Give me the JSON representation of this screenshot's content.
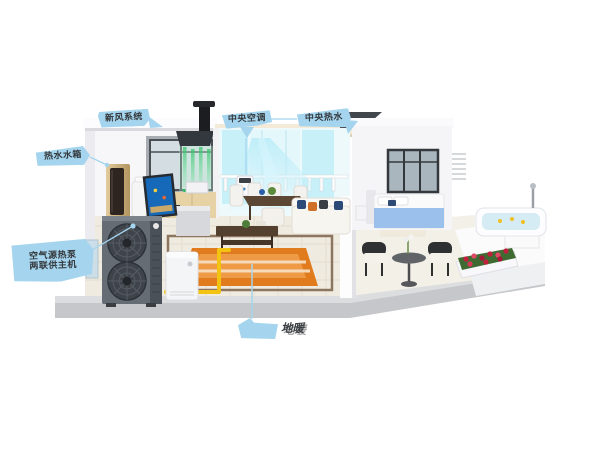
{
  "background_color": "#ffffff",
  "callouts": {
    "fresh_air": {
      "label": "新风系统"
    },
    "central_ac": {
      "label": "中央空调"
    },
    "central_hot_water": {
      "label": "中央热水"
    },
    "water_tank": {
      "label": "热水水箱"
    },
    "heat_pump": {
      "line1": "空气源热泵",
      "line2": "两联供主机"
    },
    "floor_heating": {
      "label": "地暖"
    }
  },
  "icons": {
    "callout_bubble": "blue-pointer-ribbon",
    "callout_dot": "circle-endpoint",
    "callout_arrow": "triangle-pointer"
  },
  "colors": {
    "callout_bubble": "#a5d5ee",
    "callout_text": "#33373b",
    "pipe_yellow": "#f2c411",
    "airflow_cool_cyan": "#9fe2f5",
    "airflow_fresh_green": "#3fcf77",
    "rug_orange": "#e07b1e",
    "heat_pump_body": "#666c74",
    "bed_blue": "#9cc0ec",
    "flower_red": "#c21f3f"
  }
}
